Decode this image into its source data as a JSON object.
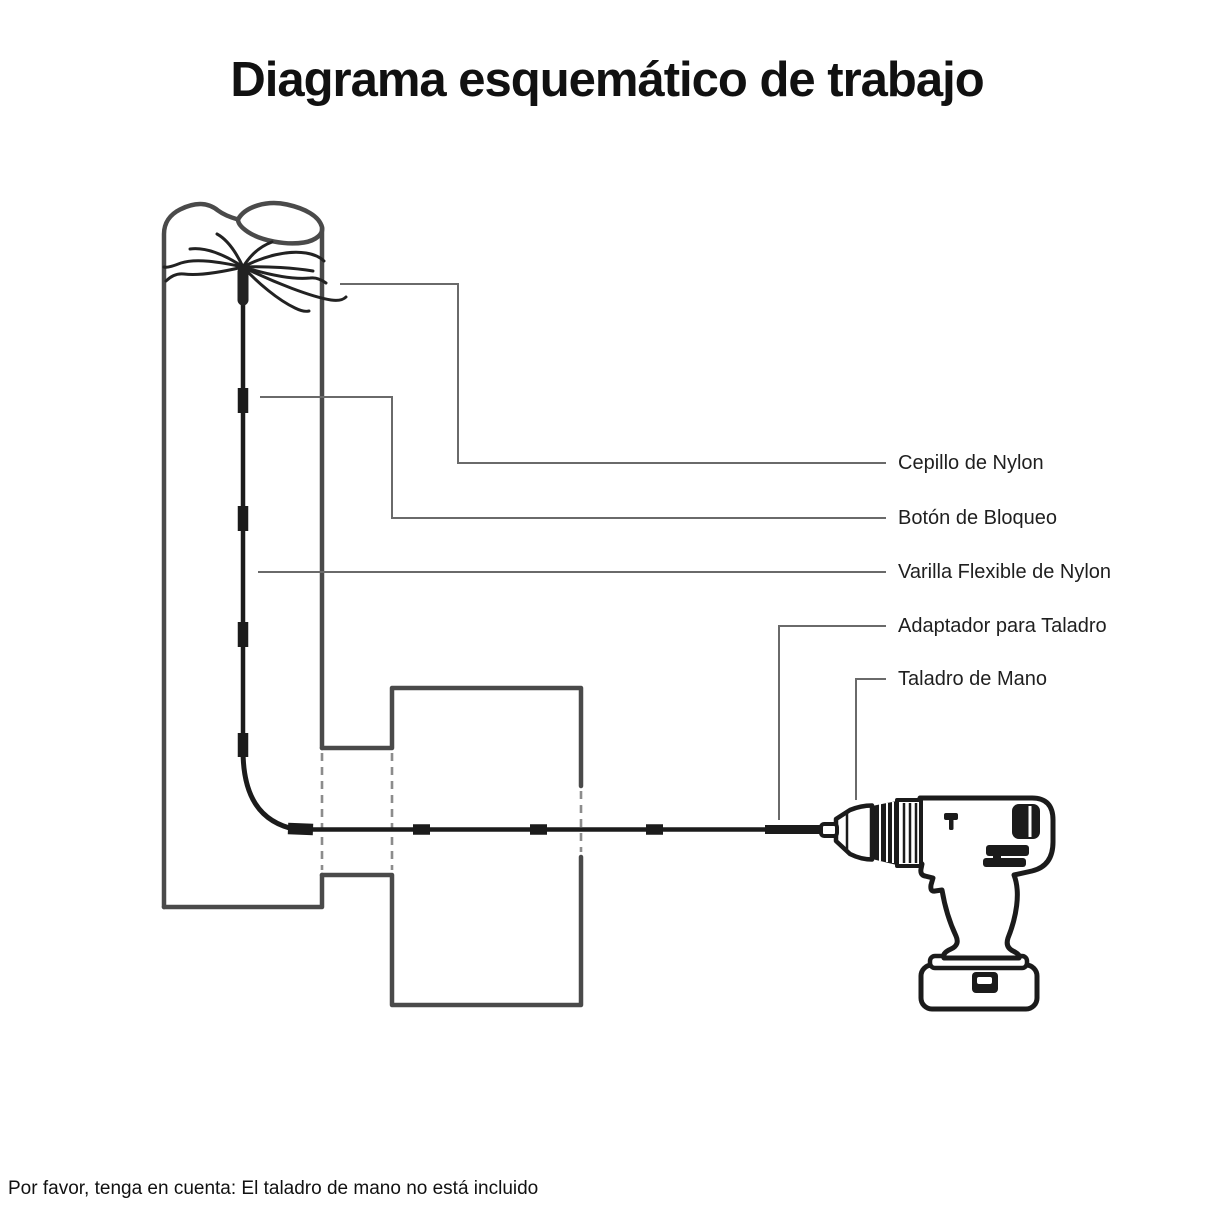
{
  "title": "Diagrama esquemático de trabajo",
  "labels": {
    "brush": "Cepillo de Nylon",
    "lock": "Botón de Bloqueo",
    "rod": "Varilla Flexible de Nylon",
    "adapter": "Adaptador para Taladro",
    "drill": "Taladro de Mano"
  },
  "note": "Por favor, tenga en cuenta: El taladro de mano no está incluido",
  "colors": {
    "background": "#ffffff",
    "structure_outline": "#4a4a4a",
    "leader_line": "#6a6a6a",
    "hidden_edge": "#8c8c8c",
    "rod_black": "#1b1b1b",
    "text": "#1a1a1a"
  }
}
